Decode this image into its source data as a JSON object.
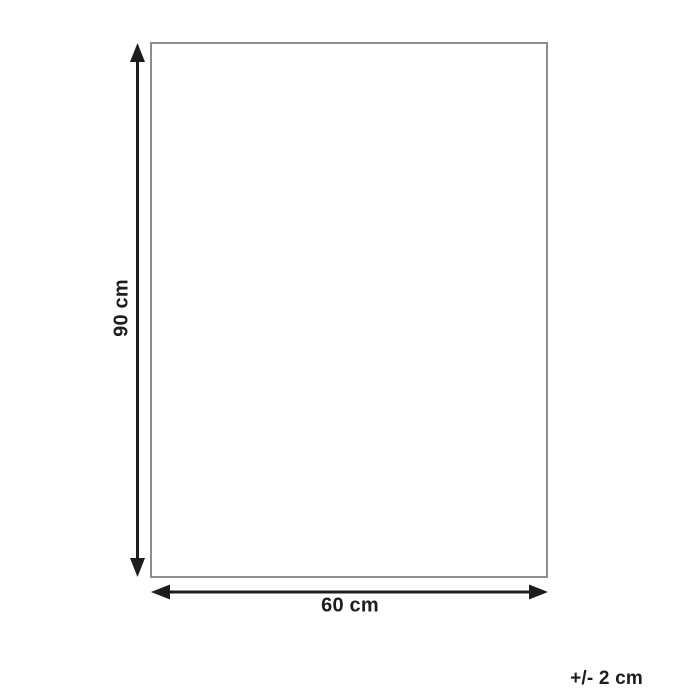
{
  "diagram": {
    "height_label": "90 cm",
    "width_label": "60 cm",
    "tolerance_label": "+/- 2 cm",
    "icons": {
      "height_arrow": "double-headed-vertical-arrow",
      "width_arrow": "double-headed-horizontal-arrow"
    }
  },
  "colors": {
    "line": "#1d1d1b",
    "outline": "#8d8d8d",
    "background": "#ffffff"
  }
}
